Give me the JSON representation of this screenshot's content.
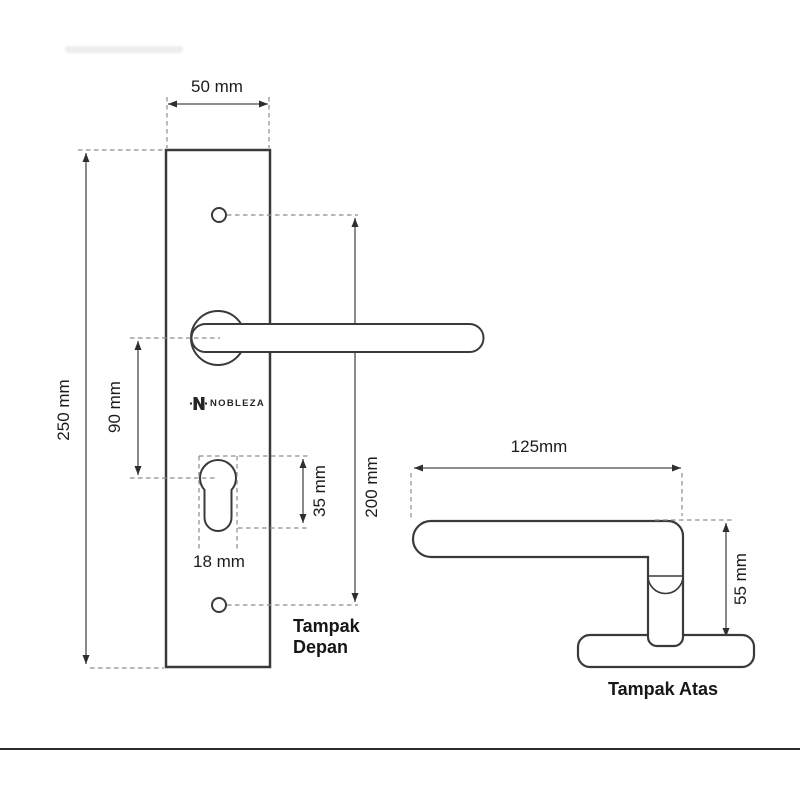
{
  "brand": {
    "name": "NOBLEZA"
  },
  "front_view": {
    "title": "Tampak Depan",
    "dim_plate_width": "50 mm",
    "dim_plate_height": "250 mm",
    "dim_handle_to_keyhole": "90 mm",
    "dim_keyhole_height": "35 mm",
    "dim_keyhole_width": "18 mm",
    "dim_hole_spacing": "200 mm"
  },
  "top_view": {
    "title": "Tampak Atas",
    "dim_lever_length": "125mm",
    "dim_total_depth": "55 mm"
  }
}
